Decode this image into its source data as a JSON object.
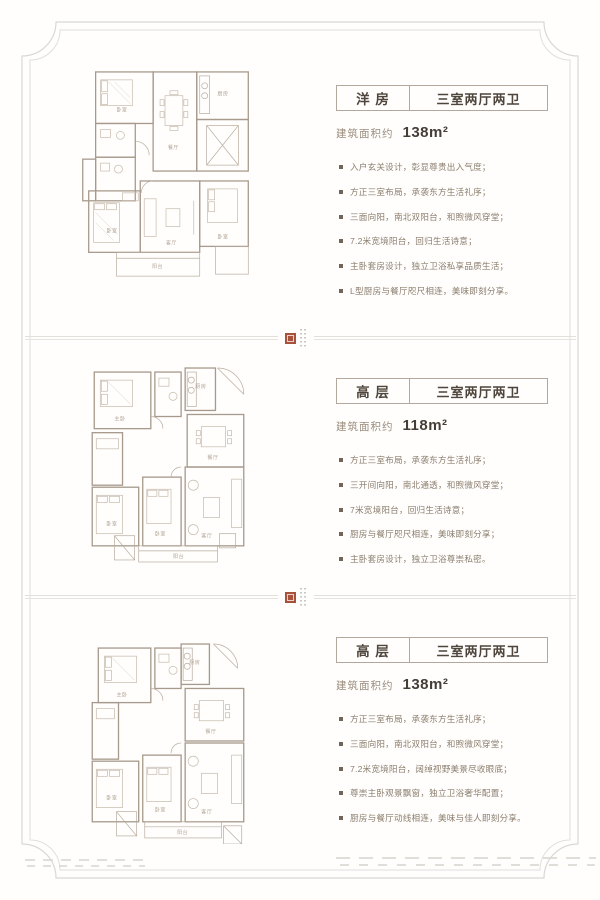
{
  "colors": {
    "accent_text": "#8b7d6d",
    "heading_text": "#4e453c",
    "box_border": "#b3a89e",
    "frame_line": "#dbd7d2",
    "seal_red": "#a8523e",
    "plan_line": "#a79a8c"
  },
  "sections": [
    {
      "type_label": "洋 房",
      "layout_label": "三室两厅两卫",
      "area_prefix": "建筑面积约",
      "area_value": "138m²",
      "features": [
        "入户玄关设计，彰显尊贵出入气度；",
        "方正三室布局，承袭东方生活礼序；",
        "三面向阳，南北双阳台，和煦微风穿堂；",
        "7.2米宽境阳台，回归生活诗意；",
        "主卧套房设计，独立卫浴私享品质生活；",
        "L型厨房与餐厅咫尺相连，美味即刻分享。"
      ]
    },
    {
      "type_label": "高 层",
      "layout_label": "三室两厅两卫",
      "area_prefix": "建筑面积约",
      "area_value": "118m²",
      "features": [
        "方正三室布局，承袭东方生活礼序；",
        "三开间向阳，南北通透，和煦微风穿堂；",
        "7米宽境阳台，回归生活诗意；",
        "厨房与餐厅咫尺相连，美味即刻分享；",
        "主卧套房设计，独立卫浴尊崇私密。"
      ]
    },
    {
      "type_label": "高 层",
      "layout_label": "三室两厅两卫",
      "area_prefix": "建筑面积约",
      "area_value": "138m²",
      "features": [
        "方正三室布局，承袭东方生活礼序；",
        "三面向阳，南北双阳台，和煦微风穿堂；",
        "7.2米宽境阳台，阔绰视野美景尽收眼底；",
        "尊崇主卧观景飘窗，独立卫浴奢华配置；",
        "厨房与餐厅动线相连，美味与佳人即刻分享。"
      ]
    }
  ],
  "plans": {
    "p1": {
      "rooms": [
        "卧室",
        "餐厅",
        "厨房",
        "卧室",
        "客厅",
        "卧室",
        "阳台"
      ]
    },
    "p2": {
      "rooms": [
        "主卧",
        "厨房",
        "餐厅",
        "卧室",
        "卧室",
        "客厅",
        "阳台"
      ]
    },
    "p3": {
      "rooms": [
        "主卧",
        "厨房",
        "餐厅",
        "卧室",
        "卧室",
        "客厅",
        "阳台"
      ]
    }
  }
}
